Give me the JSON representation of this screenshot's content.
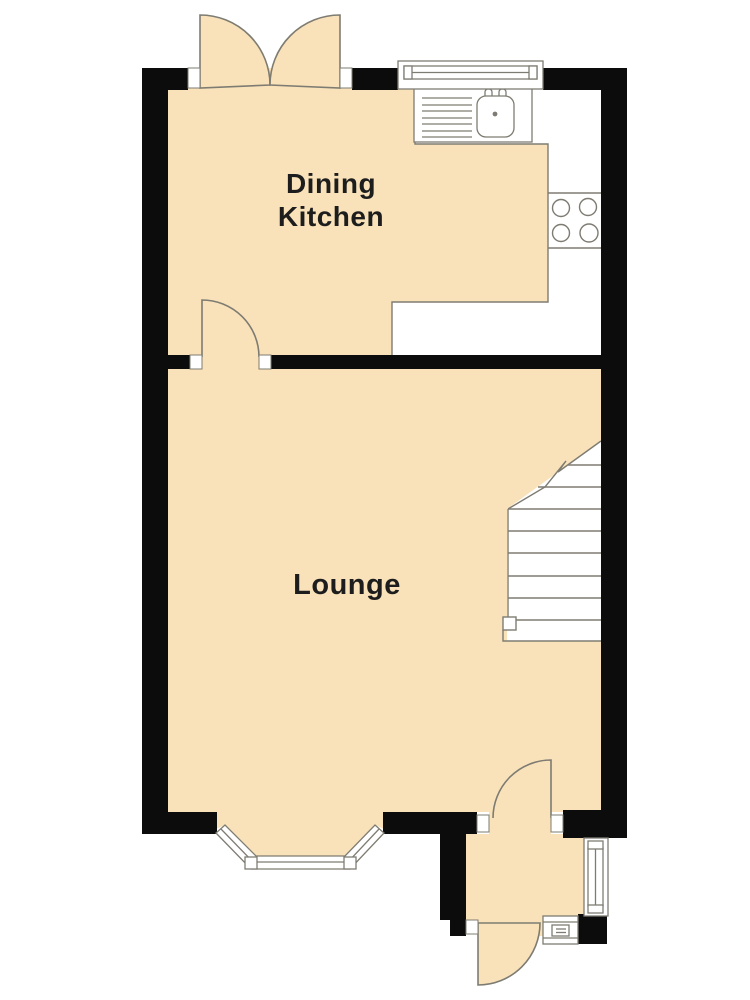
{
  "plan": {
    "type": "floor-plan",
    "rooms": [
      {
        "id": "dining-kitchen",
        "label": "Dining Kitchen"
      },
      {
        "id": "lounge",
        "label": "Lounge"
      }
    ],
    "fixtures": [
      "double-patio-door",
      "kitchen-window",
      "sink-drainer-unit",
      "hob-4-ring",
      "worktop-counter",
      "internal-door",
      "staircase",
      "bay-window",
      "hall-door",
      "porch",
      "porch-window",
      "front-door",
      "meter-box"
    ],
    "colors": {
      "floor": "#f9e2ba",
      "wall": "#0c0c0c",
      "outline": "#7e7c72",
      "label_text": "#1d1d1d",
      "background": "#ffffff"
    }
  }
}
